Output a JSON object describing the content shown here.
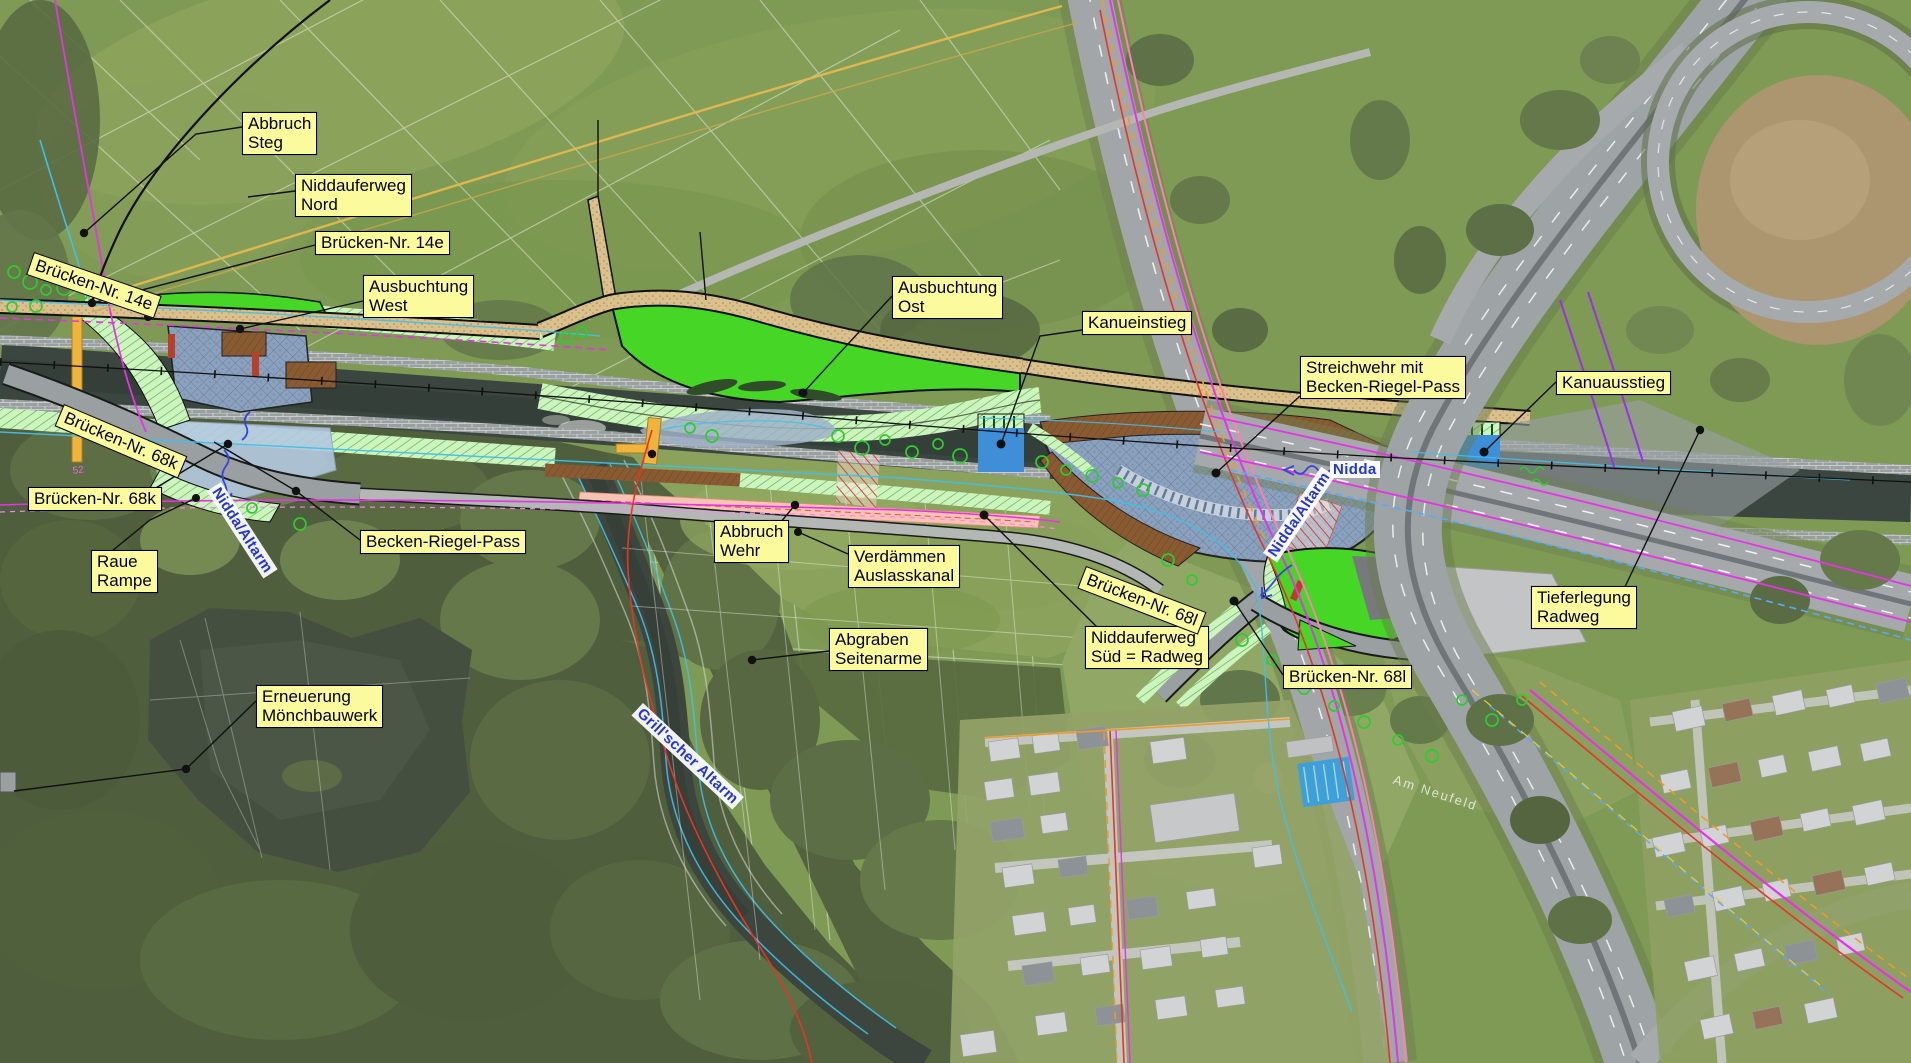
{
  "map": {
    "kind": "aerial-photo-with-construction-plan-overlay",
    "river_project_labels": [
      {
        "id": "abbruch-steg",
        "text": "Abbruch\nSteg"
      },
      {
        "id": "niddauferweg-nord",
        "text": "Niddauferweg\nNord"
      },
      {
        "id": "bruecken-nr-14e",
        "text": "Brücken-Nr. 14e"
      },
      {
        "id": "ausbuchtung-west",
        "text": "Ausbuchtung\nWest"
      },
      {
        "id": "ausbuchtung-ost",
        "text": "Ausbuchtung\nOst"
      },
      {
        "id": "kanueinstieg",
        "text": "Kanueinstieg"
      },
      {
        "id": "streichwehr",
        "text": "Streichwehr mit\nBecken-Riegel-Pass"
      },
      {
        "id": "kanuausstieg",
        "text": "Kanuausstieg"
      },
      {
        "id": "bruecken-nr-68k",
        "text": "Brücken-Nr. 68k"
      },
      {
        "id": "raue-rampe",
        "text": "Raue\nRampe"
      },
      {
        "id": "becken-riegel-pass",
        "text": "Becken-Riegel-Pass"
      },
      {
        "id": "abbruch-wehr",
        "text": "Abbruch\nWehr"
      },
      {
        "id": "verdaemmen-auslasskanal",
        "text": "Verdämmen\nAuslasskanal"
      },
      {
        "id": "abgraben-seitenarme",
        "text": "Abgraben\nSeitenarme"
      },
      {
        "id": "niddauferweg-sued",
        "text": "Niddauferweg\nSüd = Radweg"
      },
      {
        "id": "bruecken-nr-68l",
        "text": "Brücken-Nr. 68l"
      },
      {
        "id": "tieferlegung-radweg",
        "text": "Tieferlegung\nRadweg"
      },
      {
        "id": "erneuerung-moenchbauwerk",
        "text": "Erneuerung\nMönchbauwerk"
      },
      {
        "id": "bruecken-nr-14e-tag",
        "text": "Brücken-Nr. 14e",
        "rotation_deg": 19
      },
      {
        "id": "bruecken-nr-68k-tag",
        "text": "Brücken-Nr. 68k",
        "rotation_deg": 23
      },
      {
        "id": "bruecken-nr-68l-tag",
        "text": "Brücken-Nr. 68l",
        "rotation_deg": 21
      }
    ],
    "water_labels": [
      {
        "id": "nidda",
        "text": "Nidda"
      },
      {
        "id": "nidda-altarm-west",
        "text": "Nidda/Altarm",
        "rotation_deg": 57
      },
      {
        "id": "nidda-altarm-ost",
        "text": "Nidda/Altarm",
        "rotation_deg": -56
      },
      {
        "id": "grillscher-altarm",
        "text": "Grill'scher Altarm",
        "rotation_deg": 43
      }
    ],
    "background_texts": [
      {
        "id": "street-am-neufeld",
        "text": "Am Neufeld"
      },
      {
        "id": "parcel-52",
        "text": "52"
      }
    ],
    "legend_colors": {
      "label_bg": "#fbfb9d",
      "label_border": "#000000",
      "label_text": "#000000",
      "water_label_text": "#2336d4",
      "plan_bright_green": "#45d626",
      "plan_hatch_green": "#cdf3bf",
      "plan_hatch_line": "#55b14b",
      "plan_water_blue": "#8ba0bc",
      "plan_pool_blue": "#b3c8e0",
      "path_tan": "#d9c08c",
      "structure_brown": "#8a5a33",
      "demolition_red": "#d93a28",
      "canal_salmon": "#f6c3b5",
      "dock_blue": "#3f8fd8",
      "bridge_highlight_yellow": "#f0b43c",
      "river_dark": "#3c4a42",
      "utility_magenta": "#e832e8",
      "utility_cyan": "#3fc0e8",
      "utility_orange": "#f09a28",
      "utility_purple": "#9a30e8",
      "utility_red": "#e83424",
      "tree_marker_green": "#2ecc2e"
    }
  }
}
